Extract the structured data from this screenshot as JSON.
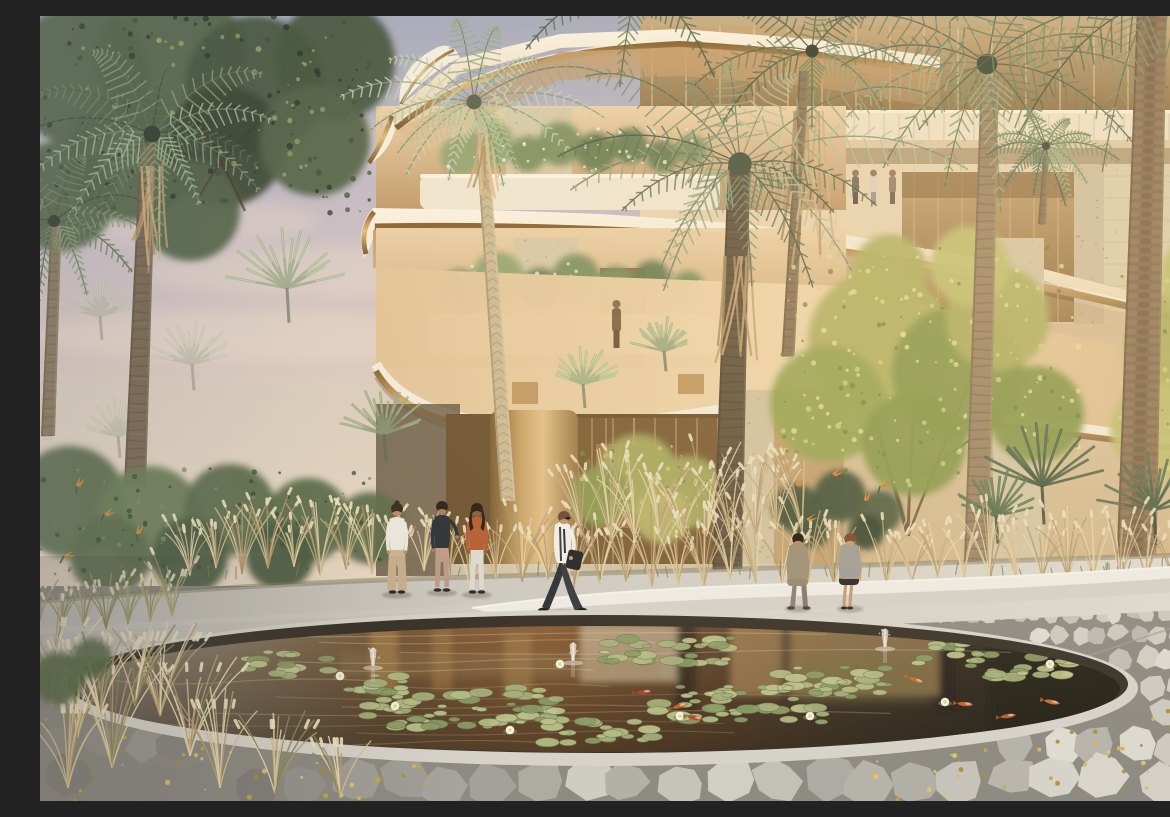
{
  "meta": {
    "title": "Luxury residence courtyard rendering with palm garden and koi pond",
    "description": "Photorealistic architectural rendering at golden hour: a curved cream apartment building with gold-trimmed cantilevered balconies, travertine columns and a glazed lobby rises behind a palm-filled garden. Tan ornamental grasses surround a curved white stone bench. In the foreground a circular reflecting pond holds water-lily pads, white lotus flowers, small fountain jets and orange koi, ringed by irregular grey flagstone paving scattered with golden petals. Six people occupy the plaza: three standing at left, a man in a white shirt walking at center, and a man and woman seated on the bench at right."
  },
  "scene": {
    "sky": {
      "time_of_day": "late afternoon",
      "clouds": "soft pink haze streaks",
      "colors": [
        "#a8abbc",
        "#c7bcc4",
        "#e0cbbd",
        "#f0dfc6",
        "#f6ecd6"
      ]
    },
    "building": {
      "floors_visible": 3,
      "style": "curved cantilevered balconies with polished gold trim",
      "materials": [
        "cream stone slabs",
        "travertine columns",
        "bronze-tinted glass",
        "gold metal fascia"
      ],
      "features": [
        "balcony planters with white flowering shrubs",
        "glazed lobby with pendant lights",
        "gold entrance cylinder",
        "residents on upper balcony"
      ]
    },
    "vegetation": {
      "palm_trees": 9,
      "background_palm_heads": 6,
      "acacia_trees": 3,
      "fan_palms": 3,
      "grass_beds": "tan plume ornamental grasses",
      "accents": [
        "bird-of-paradise flowers",
        "olive shrubs",
        "dark overhanging tree top-left"
      ]
    },
    "pond": {
      "shape": "circular reflecting pond seen in perspective",
      "fountain_jets": 3,
      "koi_fish": 8,
      "lotus_flowers": 8,
      "lily_pad_clusters": 9,
      "water_colors": [
        "#938b7e",
        "#8c6138",
        "#4b3d2b",
        "#2d2820"
      ]
    },
    "hardscape": {
      "bench": "long curved white stone bench",
      "plaza": "smooth light stone walkway",
      "foreground": "irregular flagstone crazy paving with golden fallen petals"
    },
    "people": [
      {
        "id": "woman-left",
        "pose": "standing",
        "desc": "woman in white top and beige wide-leg trousers",
        "outfit": {
          "top": "#e9e5da",
          "bottom": "#c8b18d",
          "hair": "#3a2d22",
          "skin": "#b98a66"
        }
      },
      {
        "id": "man-left",
        "pose": "standing",
        "desc": "man in dark blazer and dusty-rose trousers",
        "outfit": {
          "top": "#2f3338",
          "bottom": "#bf9a88",
          "hair": "#2e241c",
          "skin": "#a97e5c"
        }
      },
      {
        "id": "woman-orange",
        "pose": "standing",
        "desc": "woman in rust top and white trousers",
        "outfit": {
          "top": "#b45f33",
          "bottom": "#ddd9cf",
          "hair": "#2f1f16",
          "skin": "#8a5f42"
        }
      },
      {
        "id": "walking-man",
        "pose": "walking",
        "desc": "man in white shirt carrying a dark jacket",
        "outfit": {
          "top": "#f1eee6",
          "bottom": "#383b40",
          "hair": "#6b4a32",
          "skin": "#c29472"
        }
      },
      {
        "id": "seated-man",
        "pose": "seated",
        "desc": "man in sand suit seated on bench",
        "outfit": {
          "top": "#9b9077",
          "bottom": "#8c8165",
          "hair": "#201a13",
          "skin": "#b9895f"
        }
      },
      {
        "id": "seated-woman",
        "pose": "seated",
        "desc": "woman in grey jacket and dark skirt on bench",
        "outfit": {
          "top": "#a09d98",
          "bottom": "#2b2926",
          "hair": "#7a4a2e",
          "skin": "#c49a76"
        }
      }
    ],
    "balcony_figures": 3,
    "doorway_figures": 1,
    "palette": {
      "gold": "#c1924f",
      "gold_light": "#e3bd7d",
      "gold_dark": "#7d5c30",
      "cream": "#f1e4cc",
      "travertine": "#d6c7a7",
      "travertine_dark": "#a4916e",
      "glass": "#b2905f",
      "soffit": "#d8b88c",
      "palm_dark": "#5c6d51",
      "palm_mid": "#7e9071",
      "palm_light": "#a9bb95",
      "palm_pale": "#c7d2ae",
      "trunk_light": "#cbb993",
      "trunk_fiber": "#9d8766",
      "trunk_dark": "#665741",
      "dead_frond": "#c0a173",
      "acacia": "#b2b164",
      "acacia_deep": "#8a9a50",
      "grass_tan": "#d7c194",
      "grass_cream": "#e9dab4",
      "shrub_olive": "#5e6e4c",
      "foliage_dark": "#46543c",
      "bird_orange": "#d4822f",
      "bench_top": "#edebe4",
      "bench_side": "#d5d2c9",
      "plaza": "#cfcbc2",
      "stone_joint": "#8e8b83",
      "petal": "#c9a83f",
      "lily": "#a8b07d",
      "lily_light": "#c0c48e",
      "lily_deep": "#8c9c66",
      "lotus": "#f2f4e6",
      "koi": "#cd6c2e",
      "skin": "#b98a66"
    }
  }
}
